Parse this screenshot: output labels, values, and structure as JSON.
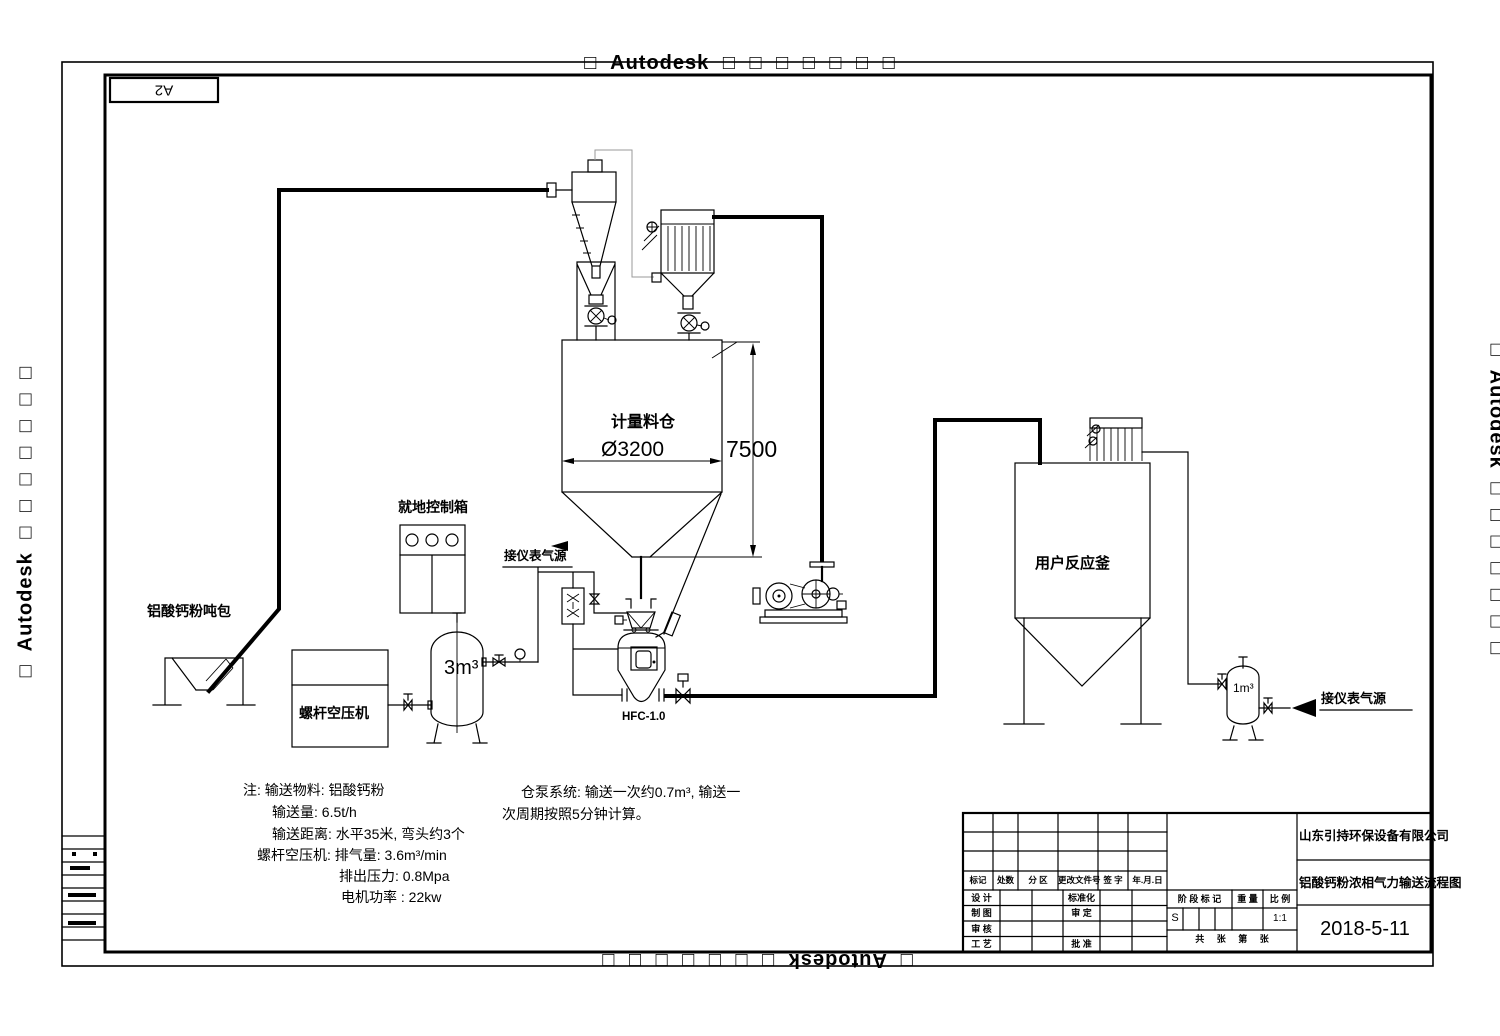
{
  "watermark": {
    "text": "□ Autodesk □ □ □ □ □ □ □"
  },
  "frame": {
    "size_label": "A2"
  },
  "labels": {
    "ton_bag": "铝酸钙粉吨包",
    "control_box": "就地控制箱",
    "compressor": "螺杆空压机",
    "air_tank_volume": "3m³",
    "silo_name": "计量料仓",
    "silo_diameter": "Ø3200",
    "silo_height": "7500",
    "bin_pump_model": "HFC-1.0",
    "instrument_air_left": "接仪表气源",
    "reactor": "用户反应釜",
    "small_tank_volume": "1m³",
    "instrument_air_right": "接仪表气源"
  },
  "notes": [
    "注: 输送物料: 铝酸钙粉",
    "输送量: 6.5t/h",
    "输送距离: 水平35米, 弯头约3个",
    "螺杆空压机: 排气量: 3.6m³/min",
    "排出压力: 0.8Mpa",
    "电机功率 : 22kw"
  ],
  "pump_note": [
    "仓泵系统: 输送一次约0.7m³, 输送一",
    "次周期按照5分钟计算。"
  ],
  "tb": {
    "company": "山东引持环保设备有限公司",
    "drawing_title": "铝酸钙粉浓相气力输送流程图",
    "date": "2018-5-11",
    "h_mark": "标记",
    "h_count": "处数",
    "h_zone": "分 区",
    "h_doc": "更改文件号",
    "h_sign": "签 字",
    "h_date": "年.月.日",
    "r_design": "设 计",
    "r_draft": "制 图",
    "r_check": "审 核",
    "r_craft": "工 艺",
    "r_std": "标准化",
    "r_verify": "审 定",
    "r_approve": "批 准",
    "stage": "阶 段 标 记",
    "weight": "重 量",
    "scale": "比 例",
    "stage_val": "S",
    "scale_val": "1:1",
    "sheets": "共  张  第  张"
  }
}
